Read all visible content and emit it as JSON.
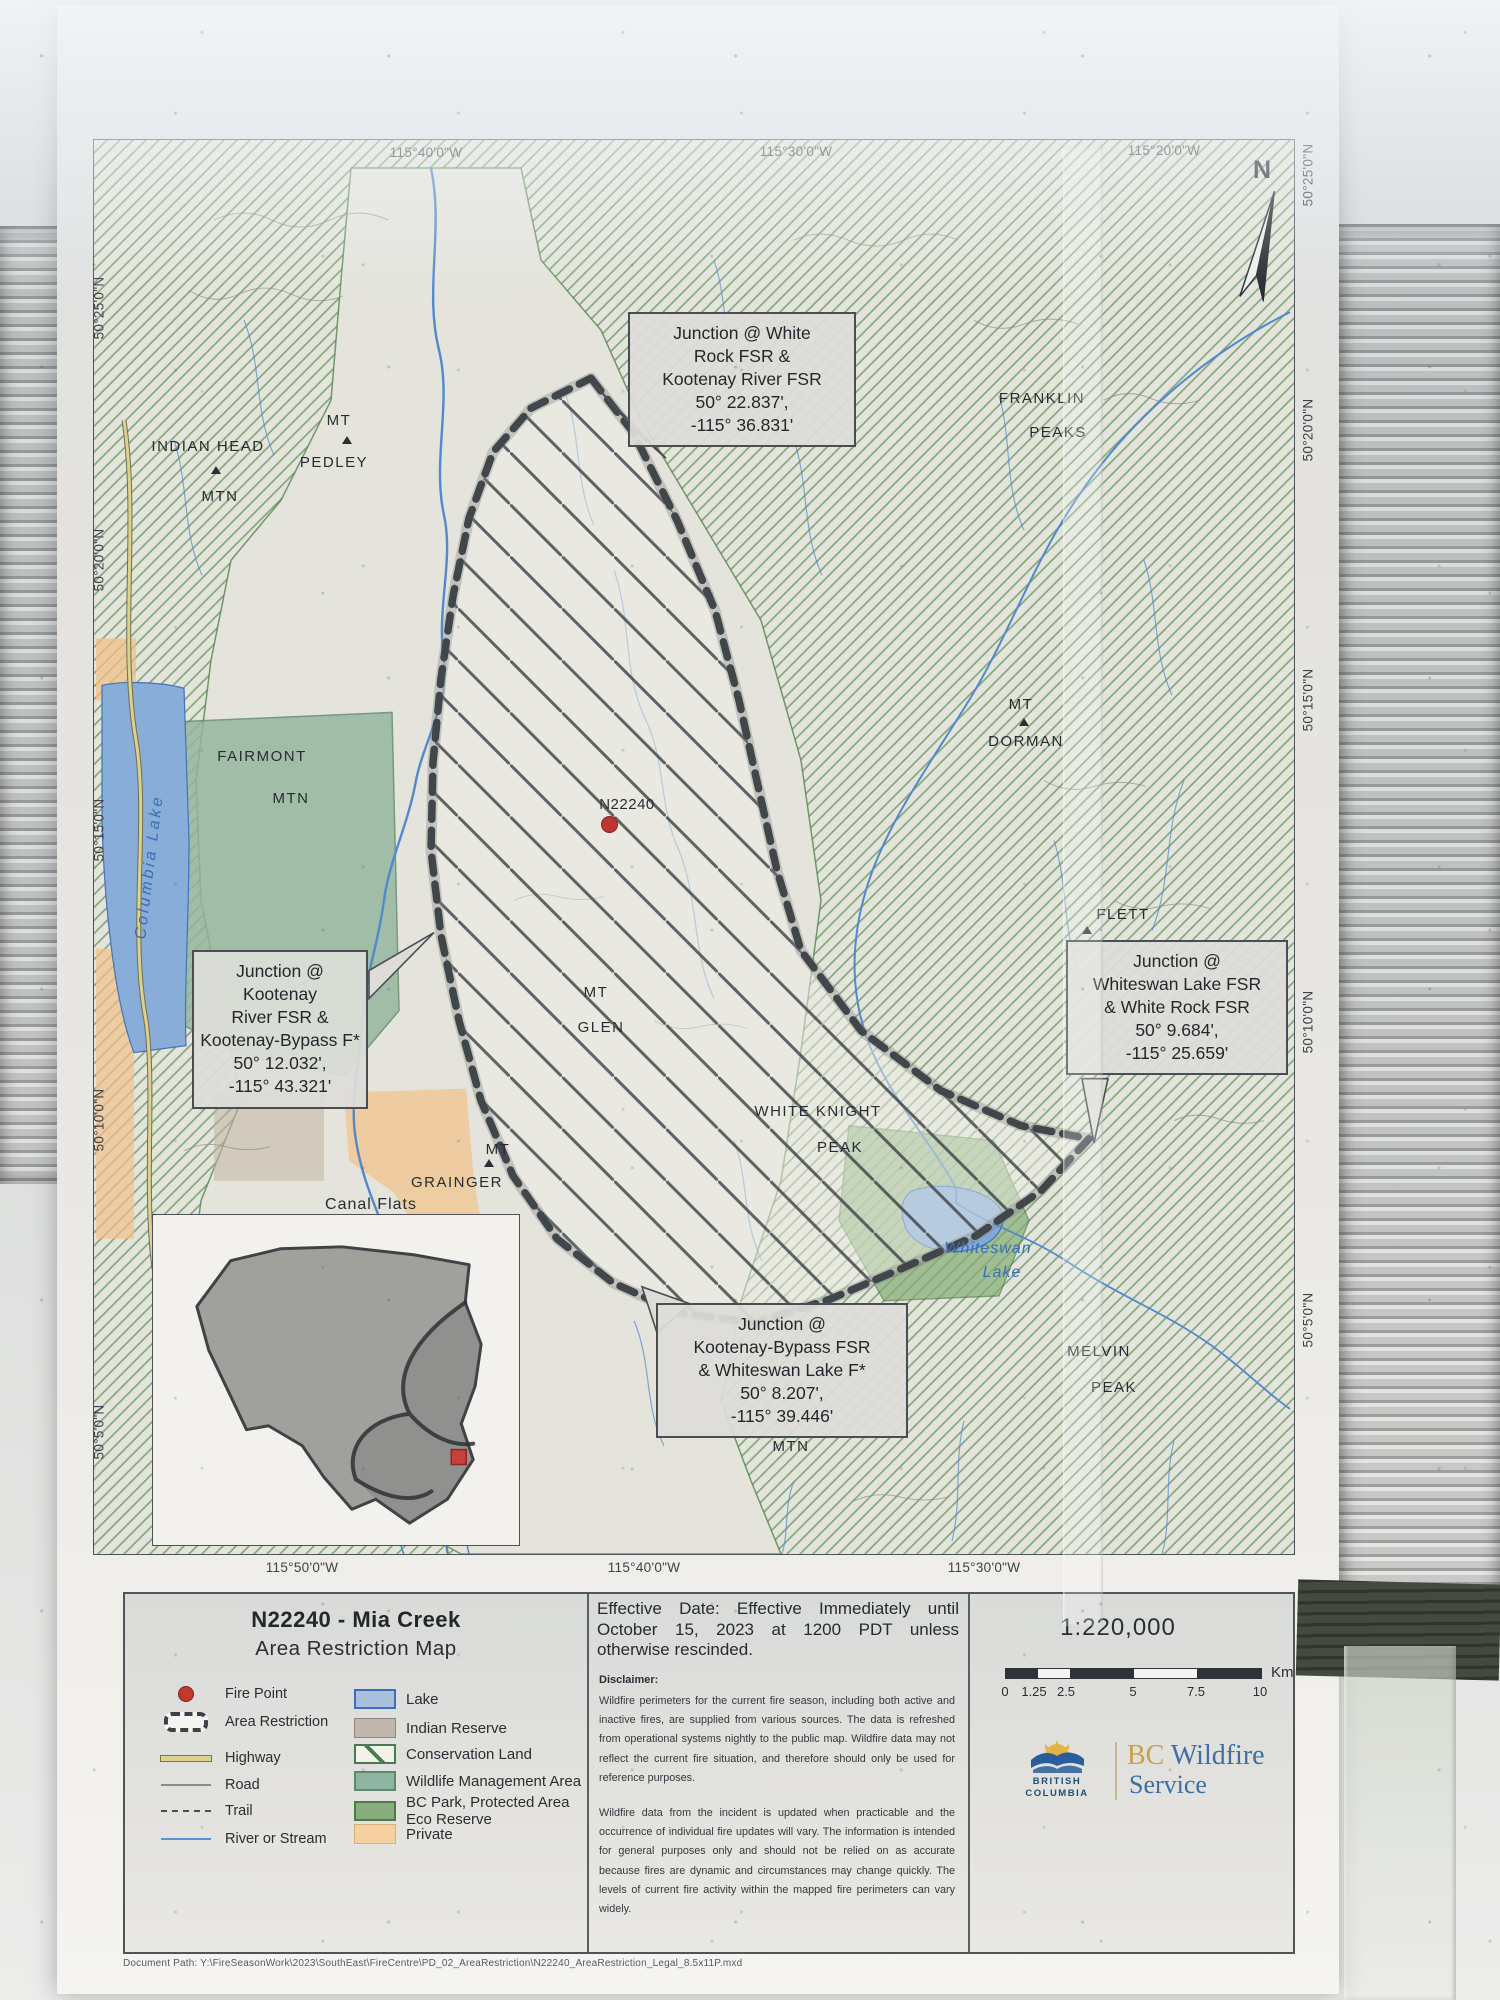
{
  "map": {
    "north_label": "N",
    "fire_label": "N22240",
    "graticule": {
      "top": [
        "115°40'0\"W",
        "115°30'0\"W",
        "115°20'0\"W"
      ],
      "bottom": [
        "115°50'0\"W",
        "115°40'0\"W",
        "115°30'0\"W"
      ],
      "left": [
        "50°25'0\"N",
        "50°20'0\"N",
        "50°15'0\"N",
        "50°10'0\"N",
        "50°5'0\"N"
      ],
      "right": [
        "50°25'0\"N",
        "50°20'0\"N",
        "50°15'0\"N",
        "50°10'0\"N",
        "50°5'0\"N"
      ]
    },
    "labels": [
      {
        "line1": "INDIAN HEAD",
        "line2": "MTN"
      },
      {
        "line1": "MT",
        "line2": "PEDLEY"
      },
      {
        "line1": "FRANKLIN",
        "line2": "PEAKS"
      },
      {
        "line1": "MT",
        "line2": "DORMAN"
      },
      {
        "line1": "FLETT"
      },
      {
        "line1": "FAIRMONT",
        "line2": "MTN"
      },
      {
        "line1": "MT",
        "line2": "GLEN"
      },
      {
        "line1": "WHITE KNIGHT",
        "line2": "PEAK"
      },
      {
        "line1": "MT",
        "line2": "GRAINGER"
      },
      {
        "line1": "Canal Flats"
      },
      {
        "line1": "MELVIN",
        "line2": "PEAK"
      },
      {
        "line1": "Whiteswan",
        "line2": "Lake"
      },
      {
        "line1": "Columbia Lake"
      },
      {
        "line1": "MTN"
      }
    ],
    "callouts": [
      {
        "lines": [
          "Junction @ White",
          "Rock FSR &",
          "Kootenay River FSR",
          "50° 22.837',",
          "-115° 36.831'"
        ]
      },
      {
        "lines": [
          "Junction @ Kootenay",
          "River FSR &",
          "Kootenay-Bypass F*",
          "50° 12.032',",
          "-115° 43.321'"
        ]
      },
      {
        "lines": [
          "Junction @",
          "Whiteswan Lake FSR",
          "& White Rock FSR",
          "50° 9.684',",
          "-115° 25.659'"
        ]
      },
      {
        "lines": [
          "Junction @",
          "Kootenay-Bypass FSR",
          "& Whiteswan Lake F*",
          "50° 8.207',",
          "-115° 39.446'"
        ]
      }
    ]
  },
  "legend": {
    "title_line1": "N22240 - Mia Creek",
    "title_line2": "Area Restriction Map",
    "symbols": [
      {
        "label": "Fire Point"
      },
      {
        "label": "Area Restriction"
      },
      {
        "label": "Highway"
      },
      {
        "label": "Road"
      },
      {
        "label": "Trail"
      },
      {
        "label": "River or Stream"
      }
    ],
    "areas": [
      {
        "label": "Lake"
      },
      {
        "label": "Indian Reserve"
      },
      {
        "label": "Conservation Land"
      },
      {
        "label": "Wildlife Management Area"
      },
      {
        "label": "BC Park, Protected Area",
        "label2": "Eco Reserve"
      },
      {
        "label": "Private"
      }
    ]
  },
  "info": {
    "effective": "Effective Date: Effective Immediately until October 15, 2023 at 1200 PDT unless otherwise rescinded.",
    "disclaimer_title": "Disclaimer:",
    "disclaimer_p1": "Wildfire perimeters for the current fire season, including both active and inactive fires, are supplied from various sources. The data is refreshed from operational systems nightly to the public map. Wildfire data may not reflect the current fire situation, and therefore should only be used for reference purposes.",
    "disclaimer_p2": "Wildfire data from the incident is updated when practicable and the occurrence of individual fire updates will vary. The information is intended for general purposes only and should not be relied on as accurate because fires are dynamic and circumstances may change quickly. The levels of current fire activity within the mapped fire perimeters can vary widely."
  },
  "scalebar": {
    "ratio": "1:220,000",
    "ticks": [
      "0",
      "1.25",
      "2.5",
      "5",
      "7.5",
      "10"
    ],
    "unit": "Km"
  },
  "logo": {
    "org1": "BRITISH",
    "org2": "COLUMBIA",
    "bc": "BC",
    "name": " Wildfire",
    "name2": "Service"
  },
  "footer": {
    "document_path": "Document Path: Y:\\FireSeasonWork\\2023\\SouthEast\\FireCentre\\PD_02_AreaRestriction\\N22240_AreaRestriction_Legal_8.5x11P.mxd"
  },
  "colors": {
    "fire_point": "#c0392b",
    "lake": "#a9c0dc",
    "indian_reserve": "#c0b6ab",
    "conservation": "#4a7a4f",
    "wildlife": "#8fb4a4",
    "bc_park": "#8aad80",
    "private": "#f6d0a0",
    "restriction": "#41464b",
    "river": "#5289cc",
    "hatch_green": "#6f9f68"
  }
}
